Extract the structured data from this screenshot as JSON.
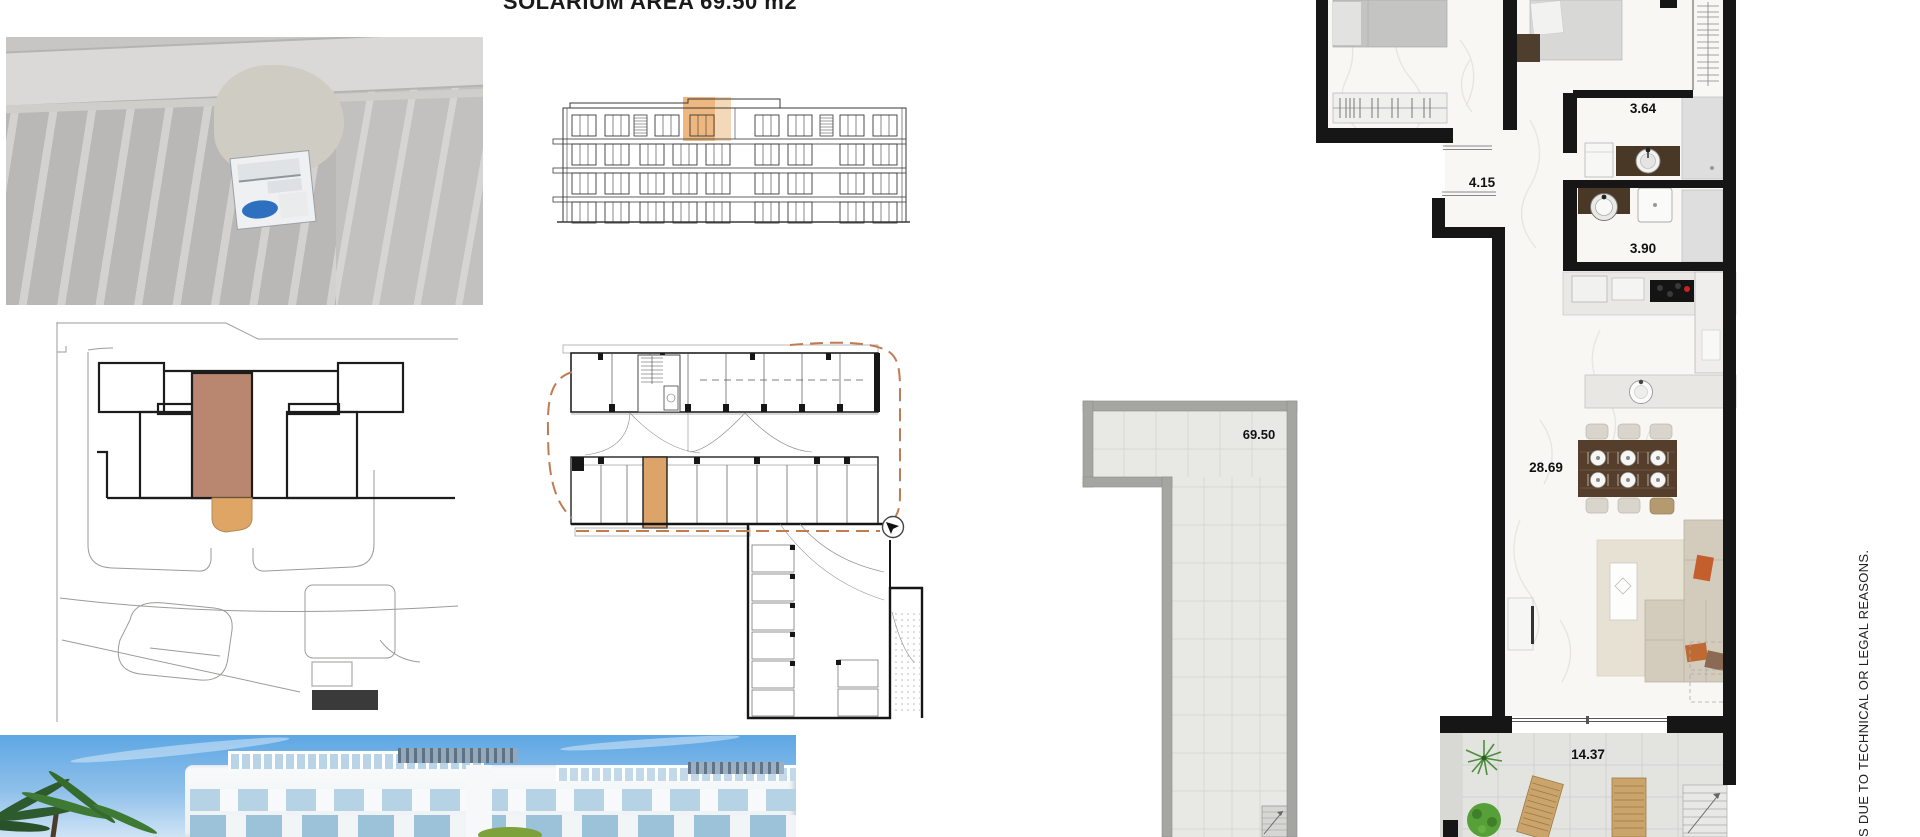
{
  "sheet": {
    "title": "SOLARIUM AREA  69.50 m2",
    "disclaimer": "S DUE TO TECHNICAL OR LEGAL REASONS."
  },
  "areas": {
    "solarium": "69.50",
    "bathroom1": "3.64",
    "hallway": "4.15",
    "bathroom2": "3.90",
    "living": "28.69",
    "terrace": "14.37"
  },
  "colors": {
    "unit_highlight_brown": "#b9876f",
    "unit_highlight_orange": "#dca469",
    "elevation_highlight": "#e8a55f",
    "boundary_dash": "#c07b53",
    "pool_blue": "#2e6fc0"
  }
}
